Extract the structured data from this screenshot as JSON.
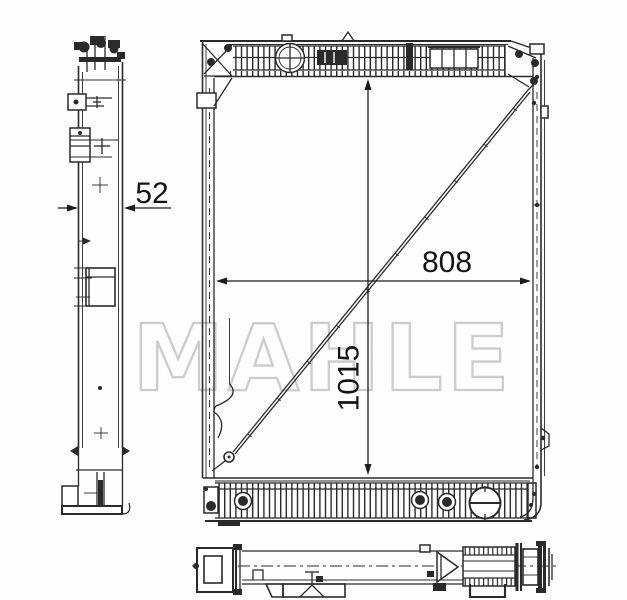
{
  "watermark": {
    "text": "MAHLE",
    "color": "#c4c4c4"
  },
  "dimensions": {
    "depth": "52",
    "core_width": "808",
    "core_height": "1015"
  },
  "colors": {
    "line": "#2a2a2a",
    "dimension_text": "#141414",
    "background": "#fefefe"
  }
}
